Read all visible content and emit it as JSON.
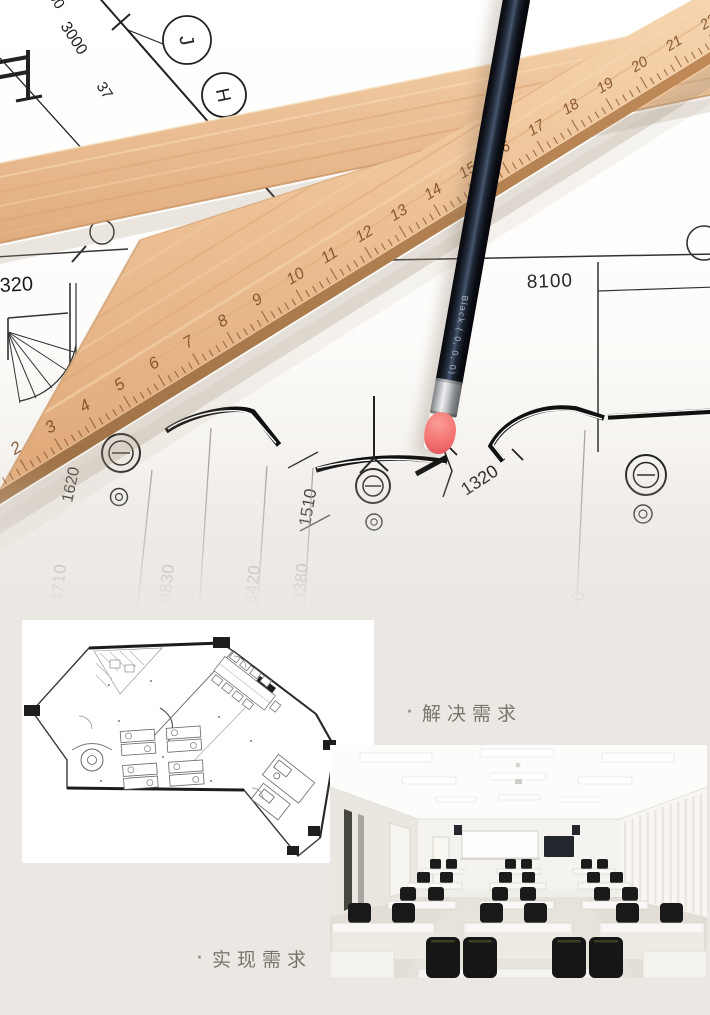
{
  "hero": {
    "ruler": {
      "numbers": [
        2,
        3,
        4,
        5,
        6,
        7,
        8,
        9,
        10,
        11,
        12,
        13,
        14,
        15,
        16,
        17,
        18,
        19,
        20,
        21,
        22
      ]
    },
    "pencil": {
      "label": "Black ( 0, 0, 0)"
    },
    "blueprint": {
      "diag_dim": "3000",
      "dim_90": "90",
      "dim_37": "37",
      "bubble_j": "J",
      "bubble_h": "H",
      "dim_320": "320",
      "dim_partial_0": "0",
      "dim_8100": "8100",
      "dim_1620": "1620",
      "dim_1510": "1510",
      "dim_1320": "1320",
      "bottom_dims": [
        {
          "label": "4710",
          "x": 62,
          "y": 603,
          "rot": -84,
          "line": [
            152,
            470,
            137,
            612
          ]
        },
        {
          "label": "9830",
          "x": 170,
          "y": 603,
          "rot": -84,
          "line": [
            211,
            428,
            199,
            612
          ]
        },
        {
          "label": "6420",
          "x": 256,
          "y": 604,
          "rot": -84,
          "line": [
            267,
            466,
            257,
            612
          ]
        },
        {
          "label": "3380",
          "x": 304,
          "y": 602,
          "rot": -84,
          "line": [
            313,
            468,
            304,
            612
          ]
        },
        {
          "label": "10580",
          "x": 581,
          "y": 640,
          "rot": -86,
          "line": [
            585,
            430,
            576,
            620
          ]
        }
      ]
    }
  },
  "sections": [
    {
      "bullet": "·",
      "label": "解决需求"
    },
    {
      "bullet": "·",
      "label": "实现需求"
    }
  ],
  "colors": {
    "wood": "#ecc39a",
    "pencil_body": "#171a22",
    "eraser": "#f3716e",
    "blueprint_line": "#222222",
    "faded_dim": "#95908a",
    "caption_text": "#7b746c",
    "page_bg": "#ebe8e4"
  }
}
